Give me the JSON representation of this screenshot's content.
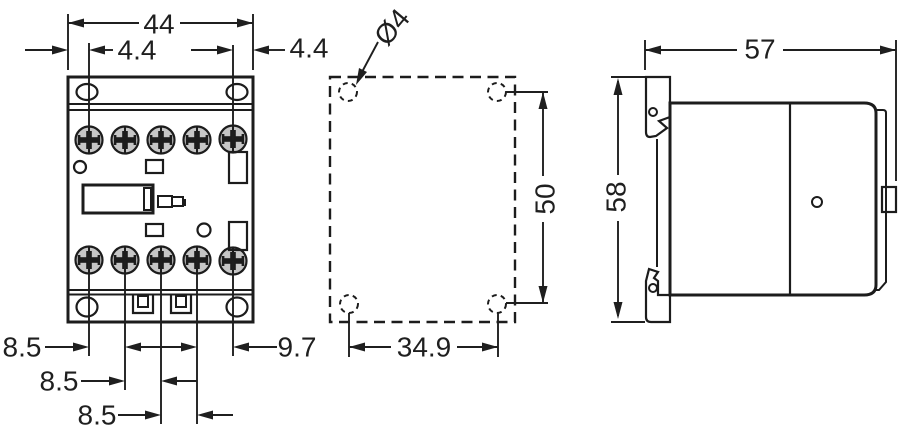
{
  "colors": {
    "background": "#ffffff",
    "body_fill": "#c6c6c6",
    "outline": "#1c1c1c",
    "dimension": "#1f1f1f"
  },
  "front_view": {
    "label_overall_width": "44",
    "label_offset_left": "4.4",
    "label_offset_right": "4.4",
    "label_terminal_pitch_1": "8.5",
    "label_terminal_pitch_2": "8.5",
    "label_terminal_pitch_3": "8.5",
    "label_terminal_pitch_right": "9.7"
  },
  "mounting_view": {
    "label_hole_diameter": "Ø4",
    "label_vertical_pitch": "50",
    "label_horizontal_pitch": "34.9"
  },
  "side_view": {
    "label_depth": "57",
    "label_height": "58"
  }
}
